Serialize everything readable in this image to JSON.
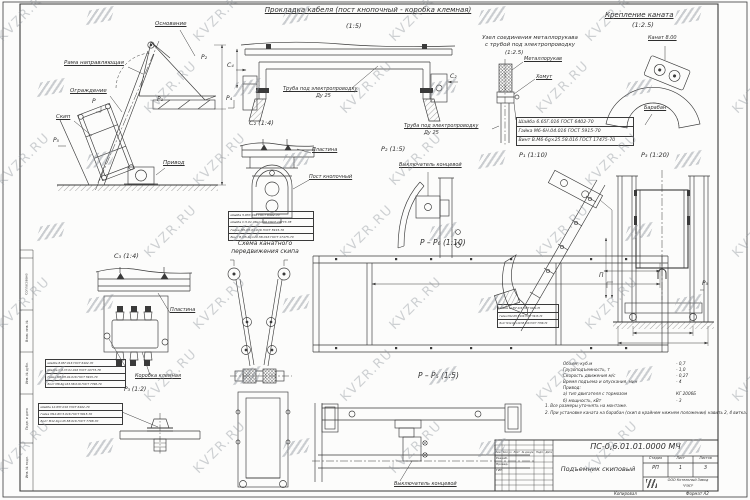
{
  "watermark": {
    "text": "KVZR.RU"
  },
  "margin_labels": [
    "Согласовано",
    "Взам. инв. №",
    "Инв. № дубл.",
    "Подп. и дата",
    "Инв. № подл."
  ],
  "views": {
    "cable_routing": {
      "title": "Прокладка кабеля (пост кнопочный - коробка клемная)",
      "scale": "(1:5)",
      "tube_label": "Труба под электропроводку",
      "tube_dn": "Ду 25",
      "marker_c4": "C₄",
      "marker_c2": "C₂",
      "marker_p4": "P₄"
    },
    "hose_joint": {
      "title_line1": "Узел соединения металлорукава",
      "title_line2": "с трубой под электропроводку",
      "scale": "(1:2.5)",
      "hose_label": "Металлорукав",
      "clamp_label": "Хомут",
      "tube_label": "Труба под электропроводку",
      "tube_dn": "Ду 25",
      "parts": [
        "Шайба 6.65Г.016 ГОСТ 6402-70",
        "Гайка М6-6Н.04.016 ГОСТ 5915-70",
        "Винт В.М6-6g×25.58.016 ГОСТ 17475-70"
      ]
    },
    "rope_mount": {
      "title": "Крепление каната",
      "scale": "(1:2.5)",
      "rope_label": "Канат 8.00",
      "drum_label": "Барабан"
    },
    "assembly": {
      "base_label": "Основание",
      "frame_label": "Рама направляющая",
      "guard_label": "Ограждение",
      "skip_label": "Скип",
      "drive_label": "Привод",
      "marker_p2": "P₂",
      "marker_p1": "P₁",
      "marker_p": "P",
      "marker_p5": "P₅"
    },
    "c2": {
      "title": "C₂ (1:4)",
      "plate_label": "Пластина",
      "post_label": "Пост кнопочный",
      "parts": [
        "Шайба 5.65Г.016 ГОСТ 6402-70",
        "Шайба С.5.01.08кп.016 ГОСТ 10773-78",
        "Гайка М5-6Н.04.016 ГОСТ 5915-70",
        "Винт В.М5-6g×20.58.016 ГОСТ 17475-70"
      ]
    },
    "rope_scheme": {
      "title_line1": "Схема канатного",
      "title_line2": "передвижения скипа"
    },
    "c3": {
      "title": "C₃ (1:4)",
      "plate_label": "Пластина",
      "box_label": "Коробка клемная",
      "parts": [
        "Шайба 8.65Г.016 ГОСТ 6402-70",
        "Шайба С.8.37.01.016 ГОСТ 10773-78",
        "Гайка М8-6Н.04.016 ГОСТ 5915-70",
        "Болт М8-6g×63.58.016 ГОСТ 7798-70"
      ]
    },
    "p3_bolt": {
      "title": "P₃ (1:2)",
      "parts": [
        "Шайба 12.65Г.016 ГОСТ 6402-70",
        "Гайка М12-6Н.5.016 ГОСТ 5915-70",
        "Болт М12-6g×45.58.016 ГОСТ 7798-70"
      ]
    },
    "pp6": {
      "title": "P – P₆ (1:10)"
    },
    "pp5": {
      "title": "P – P₅ (1:5)",
      "switch_label": "Выключатель концевой"
    },
    "p1": {
      "title": "P₁ (1:10)",
      "parts": [
        "Шайба 12.65Г.016 ГОСТ 6402-70",
        "Гайка М12-6Н.5.016 ГОСТ 5915-70",
        "Болт М12-6g×40.58.016 ГОСТ 7798-70"
      ]
    },
    "p2": {
      "title": "P₂ (1:5)",
      "switch_label": "Выключатель концевой"
    },
    "p3_20": {
      "title": "P₃ (1:20)",
      "marker_left": "П",
      "marker_right": "P₅"
    }
  },
  "specs": {
    "rows": [
      {
        "label": "Объем, куб.м",
        "value": "- 0,7"
      },
      {
        "label": "Грузоподъемность, т",
        "value": "- 1,0"
      },
      {
        "label": "Скорость движения м/с",
        "value": "- 0,27"
      },
      {
        "label": "Время подъема и опускания, мин",
        "value": "- 4"
      },
      {
        "label": "Привод:",
        "value": ""
      },
      {
        "label": "а) тип двигателя с тормозом",
        "value": "КГ 2006Б"
      },
      {
        "label": "б) мощность, кВт",
        "value": "- 3"
      }
    ]
  },
  "notes": [
    "1. Все размеры уточнять на монтаже.",
    "2. При установке каната на барабан (скип в крайнем нижнем положении) навить 2, 4 витка."
  ],
  "title_block": {
    "doc_number": "ПС-0,6.01.01.0000 МЧ",
    "doc_name": "Подъемник скиповый",
    "stage_header": "Стадия",
    "sheet_header": "Лист",
    "sheets_header": "Листов",
    "stage": "РП",
    "sheet": "1",
    "sheets": "3",
    "company_line1": "ООО Котельный Завод",
    "company_line2": "\"РЭП\"",
    "header_cells": [
      "Изм.",
      "Кол.уч",
      "Лист",
      "№ докум.",
      "Подп.",
      "Дата"
    ],
    "sig_rows": [
      "Разраб.",
      "Провер.",
      "ГИП"
    ],
    "copied_label": "Копировал",
    "format_label": "Формат А2"
  }
}
